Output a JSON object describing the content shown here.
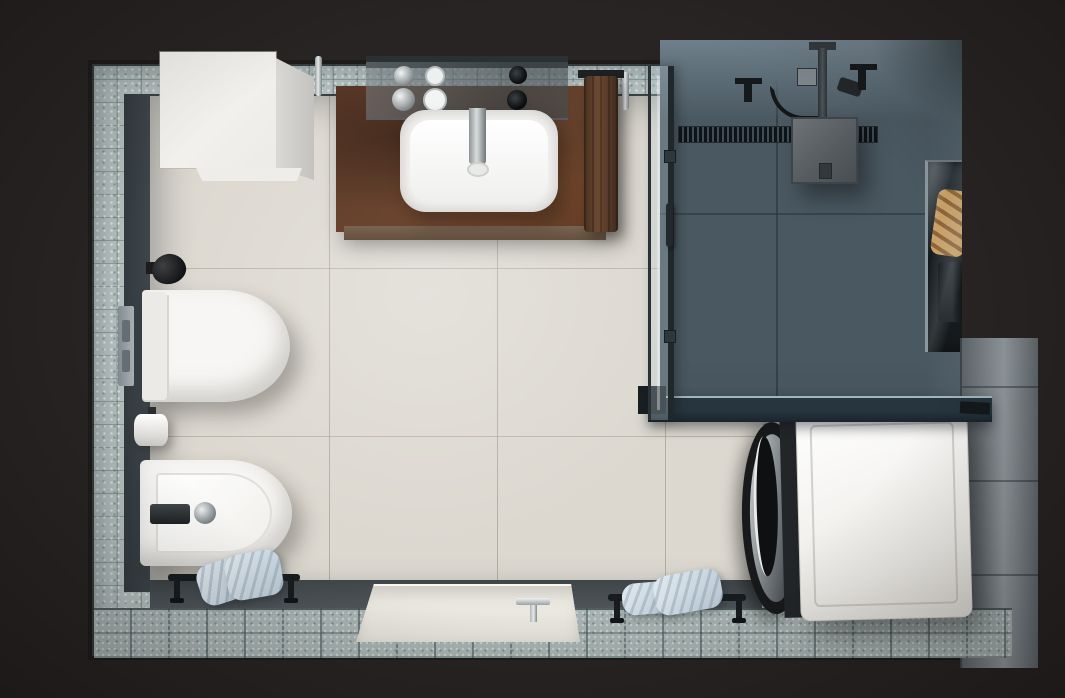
{
  "scene": {
    "type": "photorealistic 3D render",
    "view": "top-down overhead floor plan",
    "subject": "modern bathroom with walk-in slate shower, laundry corner, vanity, wall-hung toilet and bidet"
  },
  "palette": {
    "background": "#282423",
    "mosaic_wall": "#b4bfbe",
    "mosaic_floor": "#a7b2b1",
    "wall_dark": "#3b4247",
    "floor_beige": "#dcd8d0",
    "slate": "#4a5861",
    "wall_light": "#868e93",
    "rust_counter": "#66432f",
    "fixture_white": "#f7f6f4",
    "chrome": "#c9cdce",
    "black_fixture": "#17191b",
    "glass_teal": "#24333c",
    "towel_blue": "#c6d4de",
    "towel_brown": "#5d4233",
    "towel_tan": "#c49a60",
    "washer_white": "#f1efec",
    "tray_cream": "#ebe8e1"
  },
  "objects": {
    "walls": {
      "label": "mosaic tiled bathroom walls seen from above"
    },
    "floor": {
      "label": "beige large-format floor tiles"
    },
    "cabinet": {
      "label": "white storage cabinet"
    },
    "counter": {
      "label": "rust corten vanity countertop"
    },
    "shelf": {
      "label": "mirrored glass shelf with toiletries"
    },
    "sink": {
      "label": "white rectangular wash basin"
    },
    "faucet": {
      "label": "chrome basin mixer"
    },
    "towel_brown": {
      "label": "brown hand towel on rail"
    },
    "toilet": {
      "label": "wall-hung toilet"
    },
    "flush": {
      "label": "wall flush plate"
    },
    "knob": {
      "label": "black wall fitting above toilet"
    },
    "paper": {
      "label": "toilet paper roll"
    },
    "bidet": {
      "label": "wall-hung bidet with chrome mixer"
    },
    "rail1": {
      "label": "floor towel rail with rolled blue towels"
    },
    "tray": {
      "label": "low-profile cream shower tray with chrome drain handle"
    },
    "rail2": {
      "label": "floor towel rail with folded light towels"
    },
    "shower": {
      "label": "slate tiled walk-in shower zone"
    },
    "drain": {
      "label": "black linear shower drain channel"
    },
    "head": {
      "label": "ceiling mounted square rain shower head"
    },
    "valves": {
      "label": "ceiling shower valves, hose and hand shower"
    },
    "glass": {
      "label": "framed glass shower partition with handle"
    },
    "glass_shelf": {
      "label": "smoked glass panel above washer"
    },
    "niche": {
      "label": "recessed wall niche with tan towels and bottles"
    },
    "washer": {
      "label": "white front-loading washing machine, door facing left"
    },
    "wall_right": {
      "label": "grey tiled right wall"
    },
    "border_floor": {
      "label": "mosaic tile floor border along bottom wall"
    }
  }
}
